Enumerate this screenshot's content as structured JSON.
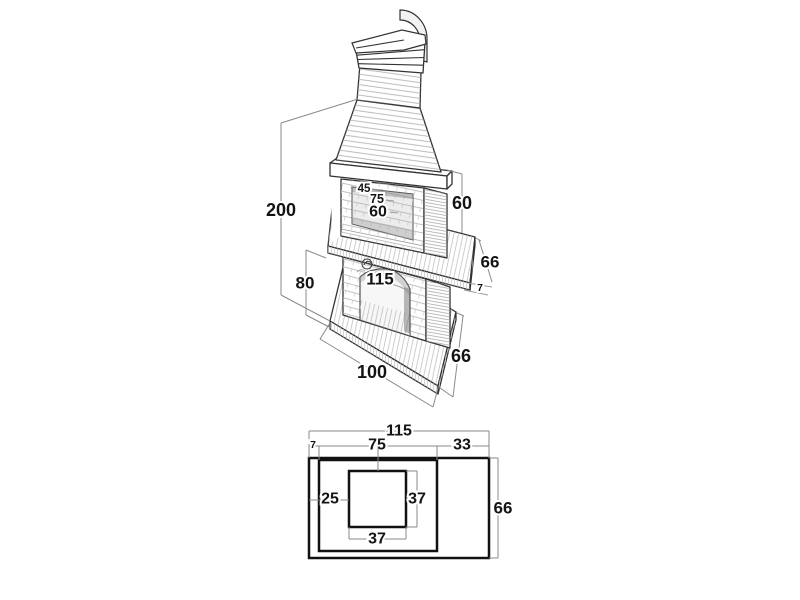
{
  "figure": {
    "description": "Technical dimension drawing of a masonry barbecue fireplace: isometric view with chimney above a plan (top) view",
    "colors": {
      "background": "#ffffff",
      "outline": "#333333",
      "dimension_line": "#8a8a8a",
      "label": "#141414"
    }
  },
  "iso": {
    "total_height": "200",
    "opening_depth": "45",
    "opening_width": "75",
    "opening_height": "60",
    "right_height": "60",
    "worktop_width": "115",
    "worktop_depth": "66",
    "worktop_thickness": "7",
    "pedestal_height": "80",
    "base_width": "100",
    "base_depth": "66"
  },
  "plan": {
    "overall_width": "115",
    "left_offset": "7",
    "pedestal_width": "75",
    "right_offset": "33",
    "flue_left_offset": "25",
    "flue_width": "37",
    "flue_depth": "37",
    "overall_depth": "66"
  }
}
